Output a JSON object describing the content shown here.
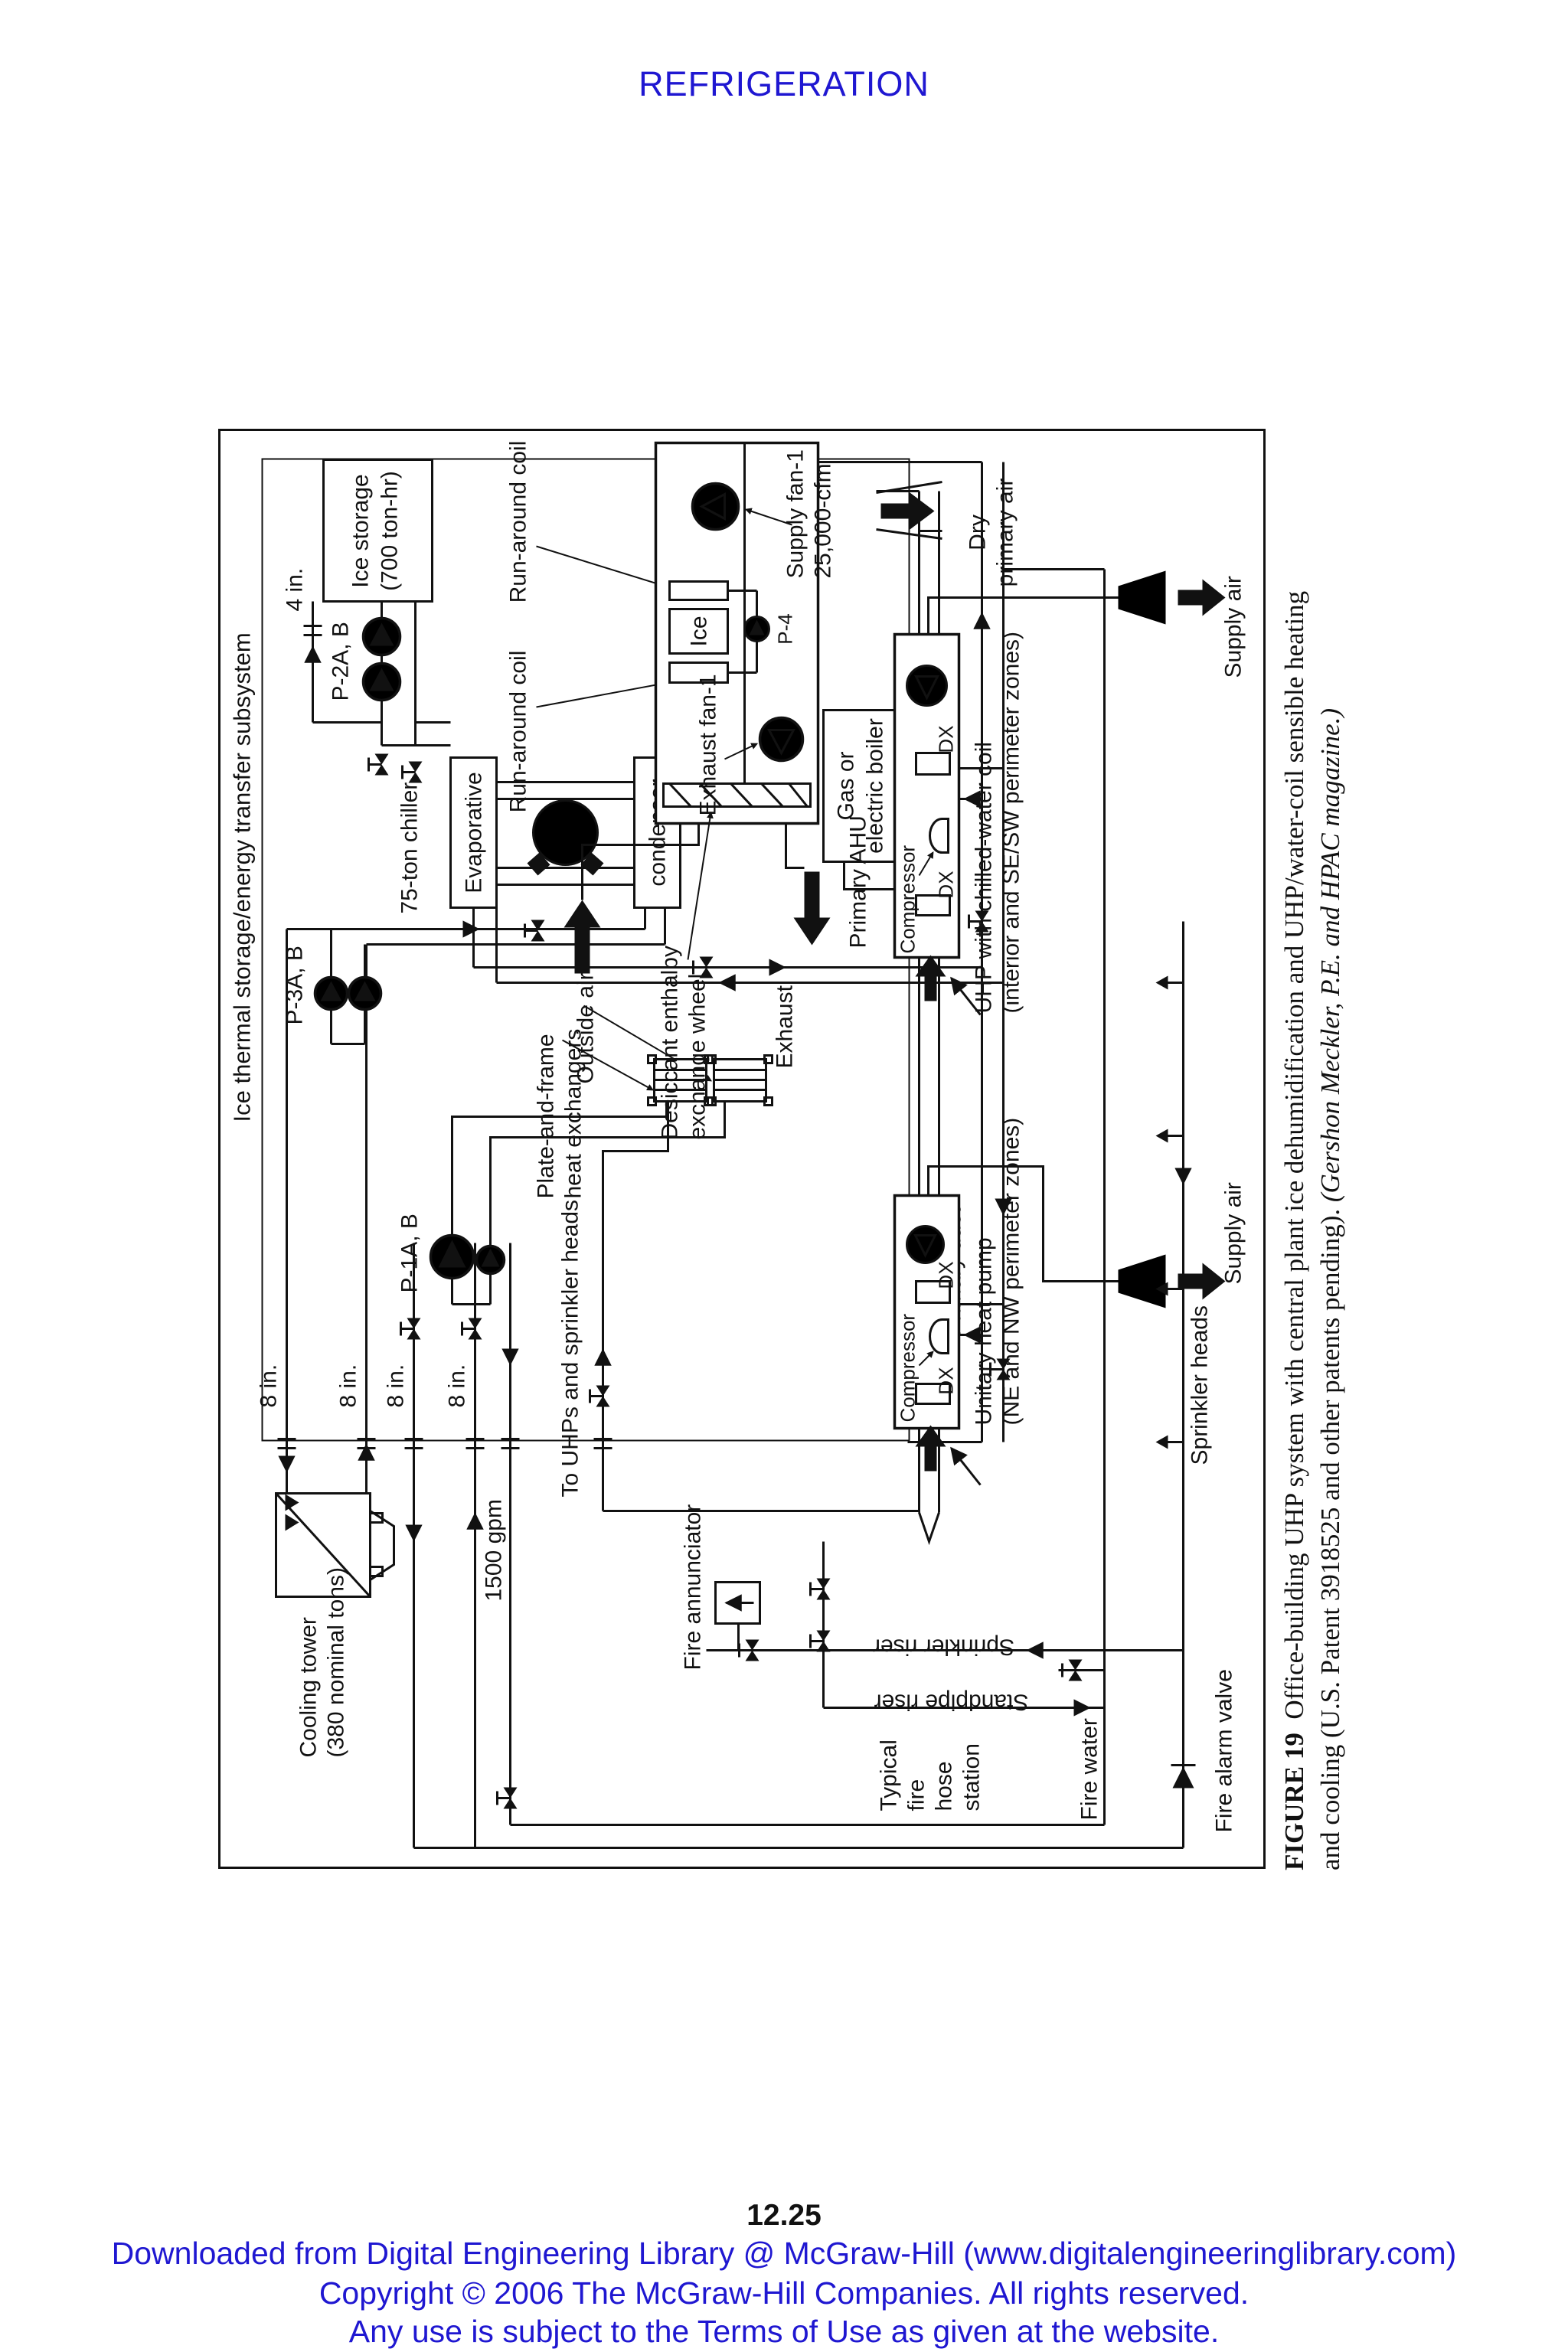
{
  "page": {
    "header": "REFRIGERATION",
    "page_number": "12.25",
    "accent_color": "#1f17d1",
    "footer": [
      "Downloaded from Digital Engineering Library @ McGraw-Hill (www.digitalengineeringlibrary.com)",
      "Copyright © 2006 The McGraw-Hill Companies. All rights reserved.",
      "Any use is subject to the Terms of Use as given at the website."
    ]
  },
  "caption": {
    "figure_label": "FIGURE 19",
    "line1": "Office-building UHP system with central plant ice dehumidification and UHP/water-coil sensible heating",
    "line2_plain": "and cooling (U.S. Patent 3918525 and other patents pending). ",
    "line2_italic": "(Gershon Meckler, P.E. and HPAC magazine.)"
  },
  "diagram": {
    "subsystem_title": "Ice thermal storage/energy transfer subsystem",
    "ice_storage_1": "Ice storage",
    "ice_storage_2": "(700 ton-hr)",
    "pipe_4in": "4 in.",
    "run_around_coil": "Run-around coil",
    "supply_fan_1": "Supply fan-1",
    "supply_fan_2": "25,000-cfm",
    "dry_primary_1": "Dry",
    "dry_primary_2": "primary air",
    "supply_air": "Supply air",
    "p2ab": "P-2A, B",
    "chiller": "75-ton chiller",
    "evaporator": "Evaporative",
    "condenser": "condenser",
    "boiler_1": "Gas or",
    "boiler_2": "electric boiler",
    "ice_coil": "Ice",
    "p4": "P-4",
    "exhaust_fan": "Exhaust fan-1",
    "primary_ahu": "Primary AHU",
    "uhp_chw_1": "UHP with chilled-water coil",
    "uhp_chw_2": "(interior and SE/SW perimeter zones)",
    "compressor": "Compressor",
    "dx": "DX",
    "p3ab": "P-3A, B",
    "desiccant_1": "Desiccant enthalpy",
    "desiccant_2": "exchange wheel",
    "outside_air": "Outside air",
    "exhaust": "Exhaust",
    "plate_frame_1": "Plate-and-frame",
    "plate_frame_2": "heat exchangers",
    "p1ab": "P-1A, B",
    "to_uhps": "To UHPs and sprinkler heads",
    "eight_in": "8 in.",
    "primary_duct": "Primary duct",
    "unitary_1": "Unitary heat pump",
    "unitary_2": "(NE and NW perimeter zones)",
    "sprinkler_heads": "Sprinkler heads",
    "sprinkler_riser": "Sprinkler riser",
    "standpipe_riser": "Standpipe riser",
    "fire_annunciator": "Fire annunciator",
    "gpm": "1500 gpm",
    "cooling_tower_1": "Cooling tower",
    "cooling_tower_2": "(380 nominal tons)",
    "hose_1": "Typical",
    "hose_2": "fire",
    "hose_3": "hose",
    "hose_4": "station",
    "fire_water": "Fire water",
    "fire_alarm_valve": "Fire alarm valve"
  }
}
